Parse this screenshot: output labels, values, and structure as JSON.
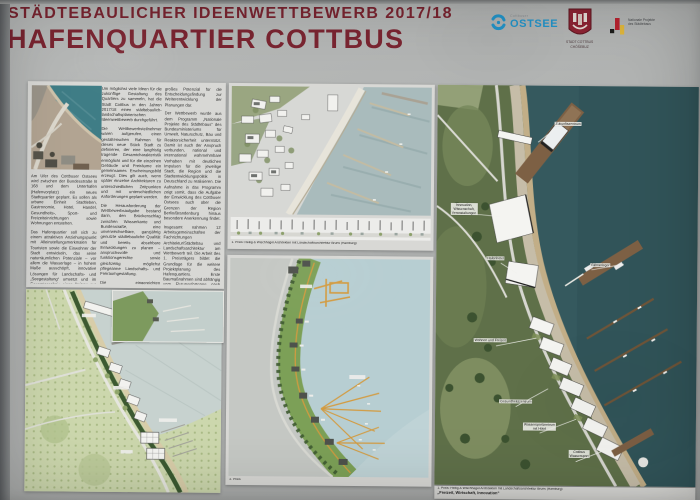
{
  "colors": {
    "title_maroon": "#7b2531",
    "ostsee_blue": "#2496cc",
    "map_water_teal": "#35595e",
    "plan_water_pale": "#b7ced2"
  },
  "header": {
    "competition": "STÄDTEBAULICHER IDEENWETTBEWERB 2017/18",
    "title": "HAFENQUARTIER COTTBUS"
  },
  "logos": {
    "ostsee_small": "Cottbuser",
    "ostsee_main": "OSTSEE",
    "city_line1": "STADT COTTBUS",
    "city_line2": "CHÓŚEBUZ",
    "national_line1": "Nationale Projekte",
    "national_line2": "des Städtebaus"
  },
  "article": {
    "col1": [
      "Am Ufer des Cottbuser Ostsees wird zwischen der Bundesstraße B 168 und dem Unterhafen (Hafenvorplatz) ein neues Stadtquartier geplant. Es sollen als urbane Einheit Stadtleben, Gastronomie, Hotel, Handel, Gesundheits-, Sport- und Freizeiteinrichtungen sowie Wohnungen entstehen.",
      "Das Hafenquartier soll sich zu einem attraktiven Anziehungspunkt mit Alleinstellungsmerkmalen für Touristen sowie die Einwohner der Stadt entwickeln, das seine naturräumlichen Potenziale – vor allem die Wasserlage – in hohem Maße ausschöpft, innovative Lösungen für Landschafts- und „Seegestaltung“ umsetzt und im Gesamtergebnis einen Beitrag zur neuen Kulturlandschaft leistet."
    ],
    "col2": [
      "Um möglichst viele Ideen für die zukünftige Gestaltung des Quartiers zu sammeln, hat die Stadt Cottbus in den Jahren 2017/18 einen städtebaulich-landschaftsplanerischen Ideenwettbewerb durchgeführt.",
      "Die Wettbewerbsteilnehmer waren aufgerufen, einen gestalterischen Rahmen für dieses neue Stück Stadt zu definieren, der eine langfristig tragende Gesamtcharakteristik ermöglicht und für die einzelnen Gebäude und Freiräume ein gemeinsames Erscheinungsbild erzeugt. Dies gilt auch, wenn später einzelne Architekturen zu unterschiedlichen Zeitpunkten und mit unterschiedlichen Anforderungen geplant werden.",
      "Die Herausforderung der Wettbewerbsaufgabe bestand darin, den Brückenschlag zwischen Wasserkante und Bundesstraße, eine unverwechselbare, ganzjährig genutzte städtebauliche Qualität und bereits absehbare Entwicklungen zu planen – anspruchsvolle und funktionsgerechte sowie gleichzeitig möglichst pflegearme Landschafts- und Freiraumgestaltung.",
      "Die eingereichten Wettbewerbsarbeiten zeigen eine große Bandbreite unterschiedlicher Konzepte auf. Ihre Qualität war überwiegend hoch; in fast jedem Entwurf war erkennbar, dass sich die Planer mit den besonderen Gegebenheiten des Ortes auseinandergesetzt haben. Die Wettbewerbsbeiträge stellen ein"
    ],
    "col3": [
      "großes Potenzial für die Entscheidungsfindung zur Weiterentwicklung der Planungen dar.",
      "Der Wettbewerb wurde aus dem Programm „Nationale Projekte des Städtebaus“ des Bundesministeriums für Umwelt, Naturschutz, Bau und Reaktorsicherheit unterstützt. Damit ist auch der Anspruch verbunden, national und international wahrnehmbare Vorhaben mit deutlichen Impulsen für die jeweilige Stadt, die Region und die Stadtentwicklungspolitik in Deutschland zu realisieren. Die Aufnahme in das Programm zeigt somit, dass die Aufgabe der Entwicklung des Cottbuser Ostsees auch über die Grenzen der Region Berlin/Brandenburg hinaus besondere Anerkennung findet.",
      "Insgesamt nahmen 12 Arbeitsgemeinschaften der Fachrichtungen Architektur/Städtebau und Landschaftsarchitektur am Wettbewerb teil. Die Arbeit des 1. Preisträgers bildet die Grundlage für die weitere Projektplanung des Hafenquartiers. Erste Baumaßnahmen sind abhängig vom Flutungsfortgang nach derzeitigem Stand für die Jahre 2024/25 geplant.",
      "Die Broschüre zur Dokumentation des Wettbewerbs lässt sich im Internet unter www.cottbuser-ostsee.de herunterladen. Dort finden Sie auch weitere aktuelle Informationen zu allen Planungen rund um den Ostsee."
    ]
  },
  "panel_top_render": {
    "caption": "1. Preis: Heilig & Wischhagel Architekten mit Landschaftsarchitektur Bruns (Hamburg)"
  },
  "panel_mid_plan": {
    "caption": "2. Preis"
  },
  "panel_big_map": {
    "labels": {
      "zukunftszentrum": "Zukunftszentrum",
      "innovation_l1": "Innovation,",
      "innovation_l2": "Wissenschaft,",
      "innovation_l3": "Veranstaltungen",
      "hafenhotel": "Hafenhotel",
      "faehranleger": "Fähranleger",
      "wohnen": "Wohnen und Freizeit",
      "gesundheit": "Gesundheitszentrum",
      "wassersport_l1": "Wassersportzentrum",
      "wassersport_l2": "mit Hotel",
      "cottbus_l1": "Cottbus",
      "cottbus_l2": "Wassersport"
    },
    "caption_line1": "1. Preis: Heilig & Wischhagel Architekten mit Landschaftsarchitektur Bruns (Hamburg)",
    "caption_line2": "„Freizeit, Wirtschaft, Innovation“"
  }
}
